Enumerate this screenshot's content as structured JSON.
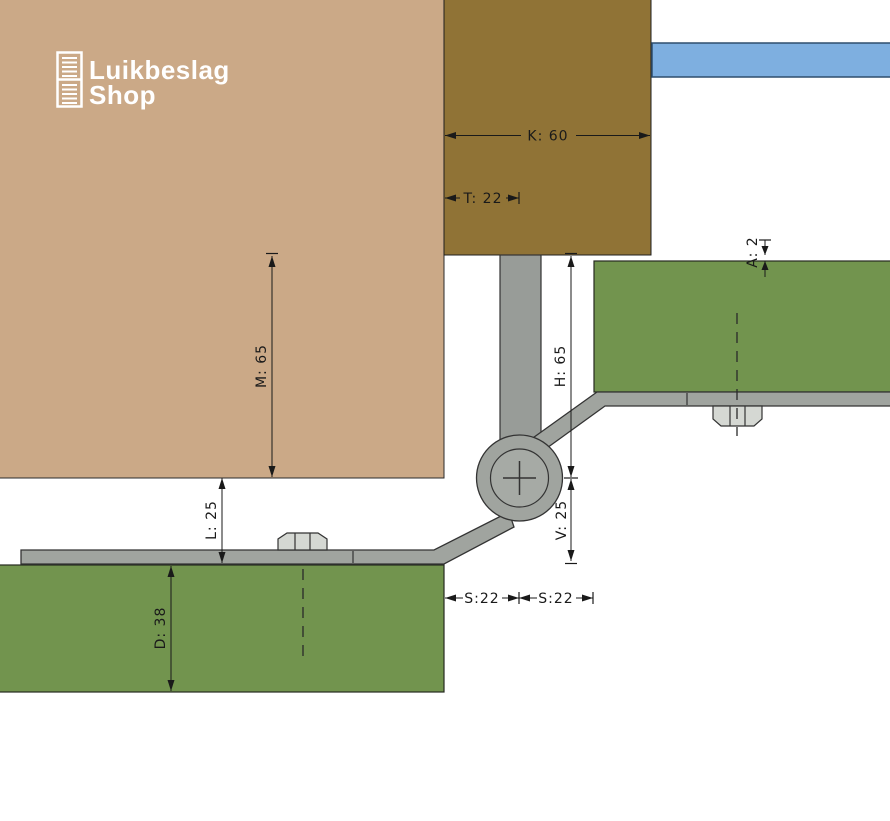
{
  "logo": {
    "brand_line1": "Luikbeslag",
    "brand_line2": "Shop"
  },
  "dimensions": {
    "K": "K: 60",
    "T": "T: 22",
    "M": "M: 65",
    "H": "H: 65",
    "V": "V: 25",
    "A": "A: 2",
    "L": "L: 25",
    "D": "D: 38",
    "S1": "S:22",
    "S2": "S:22"
  },
  "colors": {
    "wall_tan": "#CBA987",
    "frame_brown": "#907336",
    "lintel_blue": "#7EAFE0",
    "lintel_border": "#2E4E6E",
    "shutter_green": "#72944E",
    "steel_gray": "#A0A49F",
    "bolt_gray": "#D5D8D3",
    "dimension_ink": "#1a1a1a",
    "logo_white": "#ffffff",
    "background": "#ffffff"
  }
}
